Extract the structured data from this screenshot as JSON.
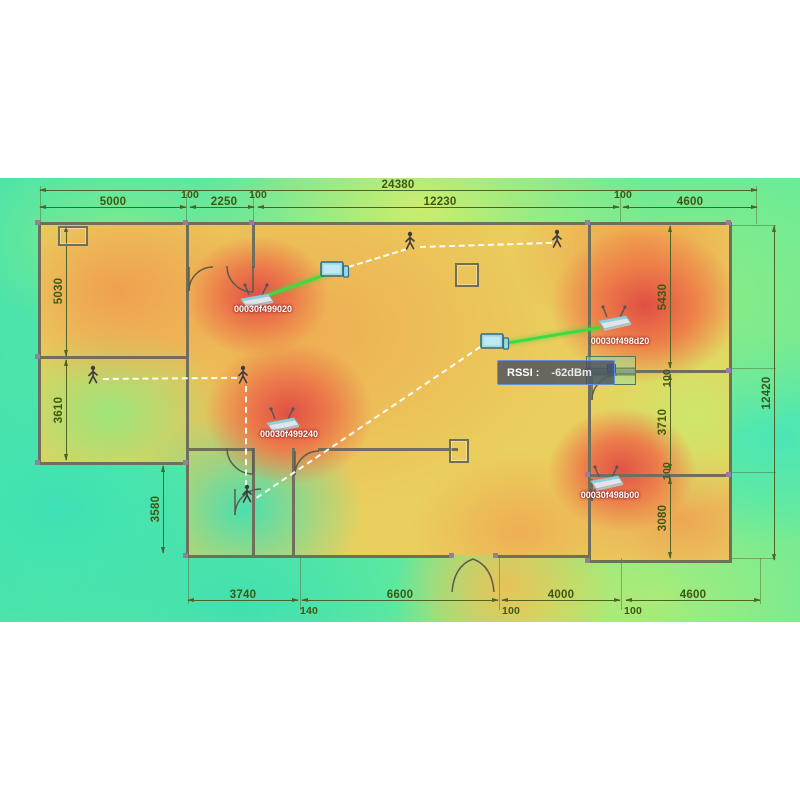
{
  "scene": {
    "title": "Wi-Fi coverage heatmap over building floor plan"
  },
  "tooltip": {
    "label": "RSSI :",
    "value": "-62dBm"
  },
  "aps": {
    "ap1": {
      "mac": "00030f499020"
    },
    "ap2": {
      "mac": "00030f499240"
    },
    "ap3": {
      "mac": "00030f498d20"
    },
    "ap4": {
      "mac": "00030f498b00"
    }
  },
  "dims": {
    "top_overall": "24380",
    "top_1": "5000",
    "top_g1": "100",
    "top_2": "2250",
    "top_g2": "100",
    "top_3": "12230",
    "top_g3": "100",
    "top_4": "4600",
    "left_1": "5030",
    "left_2": "3610",
    "left_inner": "3580",
    "right_1": "5430",
    "right_g1": "100",
    "right_2": "3710",
    "right_g2": "100",
    "right_3": "3080",
    "right_overall": "12420",
    "bottom_1": "3740",
    "bottom_g1": "140",
    "bottom_2": "6600",
    "bottom_g2": "100",
    "bottom_3": "4000",
    "bottom_g3": "100",
    "bottom_4": "4600"
  },
  "colors": {
    "hot": "#e05045",
    "warm": "#f0a050",
    "base": "#e9d05e",
    "cool": "#49e3ab",
    "link": "#3cdb42",
    "wall": "#6f6f5b",
    "dim_text": "#3f5713"
  }
}
